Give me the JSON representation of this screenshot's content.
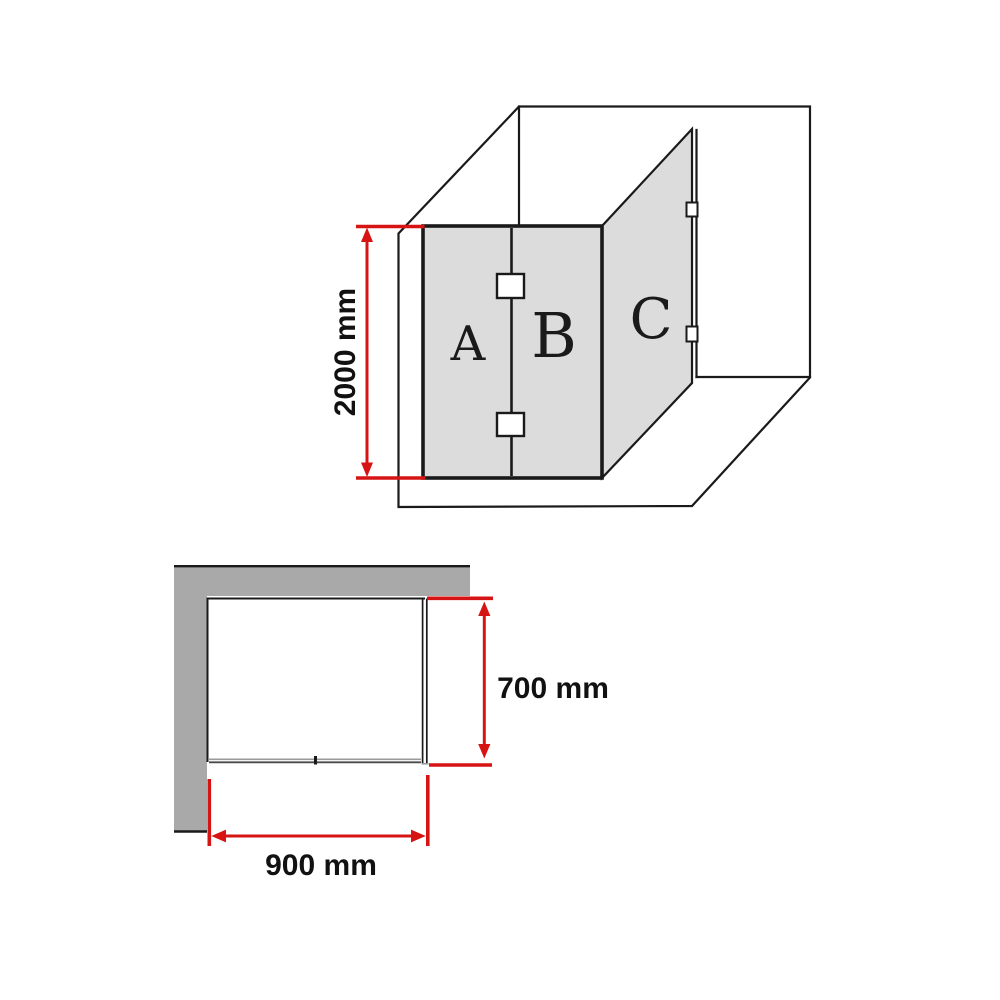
{
  "colors": {
    "dimension_red": "#d71414",
    "panel_gray": "#dcdcdc",
    "wall_gray": "#a9a9a9",
    "line_black": "#1a1a1a"
  },
  "perspective_view": {
    "panel_labels": {
      "a": "A",
      "b": "B",
      "c": "C"
    },
    "height_dimension": {
      "value": 2000,
      "unit": "mm",
      "label": "2000 mm"
    }
  },
  "plan_view": {
    "return_dimension": {
      "value": 700,
      "unit": "mm",
      "label": "700 mm"
    },
    "front_dimension": {
      "value": 900,
      "unit": "mm",
      "label": "900 mm"
    }
  }
}
